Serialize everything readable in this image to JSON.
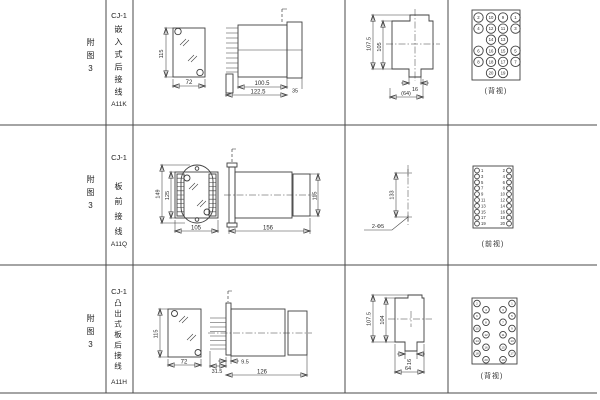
{
  "sheet": {
    "rows": [
      {
        "fig": "附图3",
        "model": "CJ-1",
        "type": "嵌入式后接线",
        "code": "A11K",
        "dims": {
          "height": "115",
          "width": "72",
          "body_len": "100.5",
          "total_len": "122.5",
          "flange": "35",
          "cut_outer": "107.5",
          "cut_inner": "105",
          "slot": "16",
          "cut_width": "(64)"
        },
        "view_label": "(背视)"
      },
      {
        "fig": "附图3",
        "model": "CJ-1",
        "type": "板前接线",
        "code": "A11Q",
        "dims": {
          "outer_height": "149",
          "inner_height": "125",
          "width": "105",
          "length": "156",
          "side_height": "115",
          "hole_span": "133",
          "holes": "2-Φ5"
        },
        "view_label": "(前视)"
      },
      {
        "fig": "附图3",
        "model": "CJ-1",
        "type": "凸出式板后接线",
        "code": "A11H",
        "dims": {
          "height": "115",
          "width": "72",
          "pin_len": "31.5",
          "offset": "9.5",
          "length": "126",
          "cut_outer": "107.5",
          "cut_inner": "104",
          "slot": "16",
          "cut_width": "64"
        },
        "view_label": "(背视)"
      }
    ]
  },
  "terminals": {
    "a11k_back": {
      "r": 4.7,
      "fs": 4.3,
      "items": [
        {
          "n": "2",
          "x": 6.5,
          "y": 7.5
        },
        {
          "n": "10",
          "x": 19,
          "y": 7.5
        },
        {
          "n": "9",
          "x": 31,
          "y": 7.5
        },
        {
          "n": "1",
          "x": 43.5,
          "y": 7.5
        },
        {
          "n": "4",
          "x": 6.5,
          "y": 18.6
        },
        {
          "n": "12",
          "x": 19,
          "y": 18.6
        },
        {
          "n": "11",
          "x": 31,
          "y": 18.6
        },
        {
          "n": "3",
          "x": 43.5,
          "y": 18.6
        },
        {
          "n": "14",
          "x": 19,
          "y": 29.7
        },
        {
          "n": "13",
          "x": 31,
          "y": 29.7
        },
        {
          "n": "6",
          "x": 6.5,
          "y": 40.8
        },
        {
          "n": "16",
          "x": 19,
          "y": 40.8
        },
        {
          "n": "15",
          "x": 31,
          "y": 40.8
        },
        {
          "n": "5",
          "x": 43.5,
          "y": 40.8
        },
        {
          "n": "8",
          "x": 6.5,
          "y": 51.9
        },
        {
          "n": "18",
          "x": 19,
          "y": 51.9
        },
        {
          "n": "17",
          "x": 31,
          "y": 51.9
        },
        {
          "n": "7",
          "x": 43.5,
          "y": 51.9
        },
        {
          "n": "20",
          "x": 19,
          "y": 63
        },
        {
          "n": "19",
          "x": 31,
          "y": 63
        }
      ]
    },
    "a11q_front": {
      "r": 2.4,
      "fs": 4.2,
      "items": [
        {
          "n": "1",
          "x": 4,
          "y": 4.5,
          "tx": 8,
          "a": "start"
        },
        {
          "n": "2",
          "x": 36,
          "y": 4.5,
          "tx": 32,
          "a": "end"
        },
        {
          "n": "3",
          "x": 4,
          "y": 10.4,
          "tx": 8,
          "a": "start"
        },
        {
          "n": "4",
          "x": 36,
          "y": 10.4,
          "tx": 32,
          "a": "end"
        },
        {
          "n": "5",
          "x": 4,
          "y": 16.3,
          "tx": 8,
          "a": "start"
        },
        {
          "n": "6",
          "x": 36,
          "y": 16.3,
          "tx": 32,
          "a": "end"
        },
        {
          "n": "7",
          "x": 4,
          "y": 22.2,
          "tx": 8,
          "a": "start"
        },
        {
          "n": "8",
          "x": 36,
          "y": 22.2,
          "tx": 32,
          "a": "end"
        },
        {
          "n": "9",
          "x": 4,
          "y": 28.1,
          "tx": 8,
          "a": "start"
        },
        {
          "n": "10",
          "x": 36,
          "y": 28.1,
          "tx": 32,
          "a": "end"
        },
        {
          "n": "11",
          "x": 4,
          "y": 34,
          "tx": 8,
          "a": "start"
        },
        {
          "n": "12",
          "x": 36,
          "y": 34,
          "tx": 32,
          "a": "end"
        },
        {
          "n": "13",
          "x": 4,
          "y": 39.9,
          "tx": 8,
          "a": "start"
        },
        {
          "n": "14",
          "x": 36,
          "y": 39.9,
          "tx": 32,
          "a": "end"
        },
        {
          "n": "15",
          "x": 4,
          "y": 45.8,
          "tx": 8,
          "a": "start"
        },
        {
          "n": "16",
          "x": 36,
          "y": 45.8,
          "tx": 32,
          "a": "end"
        },
        {
          "n": "17",
          "x": 4,
          "y": 51.7,
          "tx": 8,
          "a": "start"
        },
        {
          "n": "18",
          "x": 36,
          "y": 51.7,
          "tx": 32,
          "a": "end"
        },
        {
          "n": "19",
          "x": 4,
          "y": 57.6,
          "tx": 8,
          "a": "start"
        },
        {
          "n": "20",
          "x": 36,
          "y": 57.6,
          "tx": 32,
          "a": "end"
        }
      ]
    },
    "a11h_back": {
      "r": 3.3,
      "fs": 3,
      "items": [
        {
          "n": "2",
          "x": 5,
          "y": 5.5
        },
        {
          "n": "6",
          "x": 5,
          "y": 18
        },
        {
          "n": "10",
          "x": 5,
          "y": 30.5
        },
        {
          "n": "14",
          "x": 5,
          "y": 43
        },
        {
          "n": "18",
          "x": 5,
          "y": 55.5
        },
        {
          "n": "4",
          "x": 14,
          "y": 11.75
        },
        {
          "n": "8",
          "x": 14,
          "y": 24.25
        },
        {
          "n": "12",
          "x": 14,
          "y": 36.75
        },
        {
          "n": "16",
          "x": 14,
          "y": 49.25
        },
        {
          "n": "20",
          "x": 14,
          "y": 61.75
        },
        {
          "n": "3",
          "x": 31,
          "y": 11.75
        },
        {
          "n": "7",
          "x": 31,
          "y": 24.25
        },
        {
          "n": "11",
          "x": 31,
          "y": 36.75
        },
        {
          "n": "15",
          "x": 31,
          "y": 49.25
        },
        {
          "n": "19",
          "x": 31,
          "y": 61.75
        },
        {
          "n": "1",
          "x": 40,
          "y": 5.5
        },
        {
          "n": "5",
          "x": 40,
          "y": 18
        },
        {
          "n": "9",
          "x": 40,
          "y": 30.5
        },
        {
          "n": "13",
          "x": 40,
          "y": 43
        },
        {
          "n": "17",
          "x": 40,
          "y": 55.5
        }
      ]
    }
  }
}
